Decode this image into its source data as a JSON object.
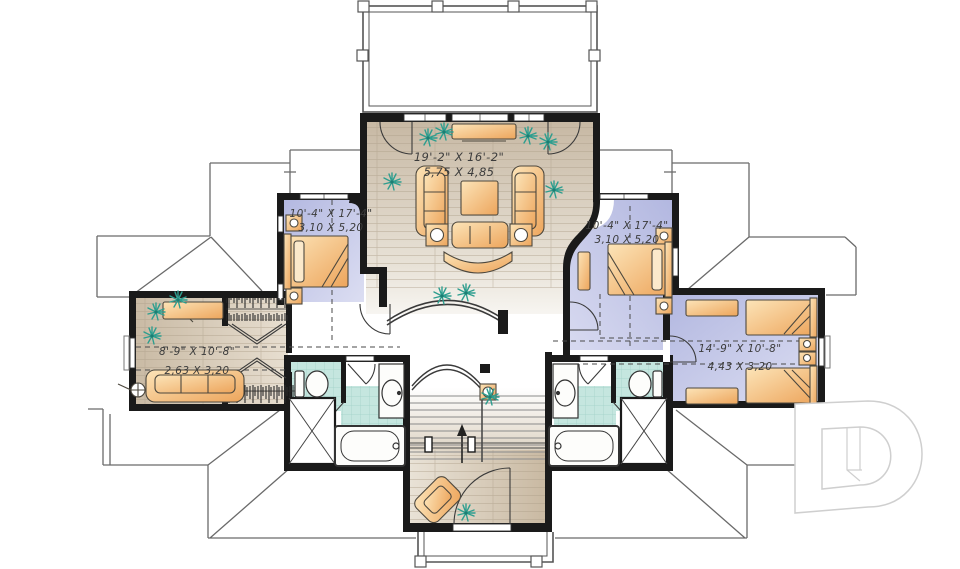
{
  "plan": {
    "rooms": [
      {
        "id": "family-room",
        "imperial": "19'-2\" X 16'-2\"",
        "metric": "5,75 X 4,85"
      },
      {
        "id": "bedroom-left",
        "imperial": "10'-4\" X 17'-4\"",
        "metric": "3,10 X 5,20"
      },
      {
        "id": "bedroom-right",
        "imperial": "10'-4\" X 17'-4\"",
        "metric": "3,10 X 5,20"
      },
      {
        "id": "bedroom-lower-left",
        "imperial": "8'-9\" X 10'-8\"",
        "metric": "2,63 X 3,20"
      },
      {
        "id": "bedroom-lower-right",
        "imperial": "14'-9\" X 10'-8\"",
        "metric": "4,43 X 3,20"
      }
    ],
    "colors": {
      "wall": "#1a1a1a",
      "bedroom_floor": "#bcc0e4",
      "wood_floor": "#cfc0ac",
      "bath_tile": "#c5e6df",
      "furniture": "#f2bd79",
      "plant": "#2e9e8f",
      "roof_line": "#6a6a6a",
      "logo_line": "#d2d2d2"
    }
  }
}
